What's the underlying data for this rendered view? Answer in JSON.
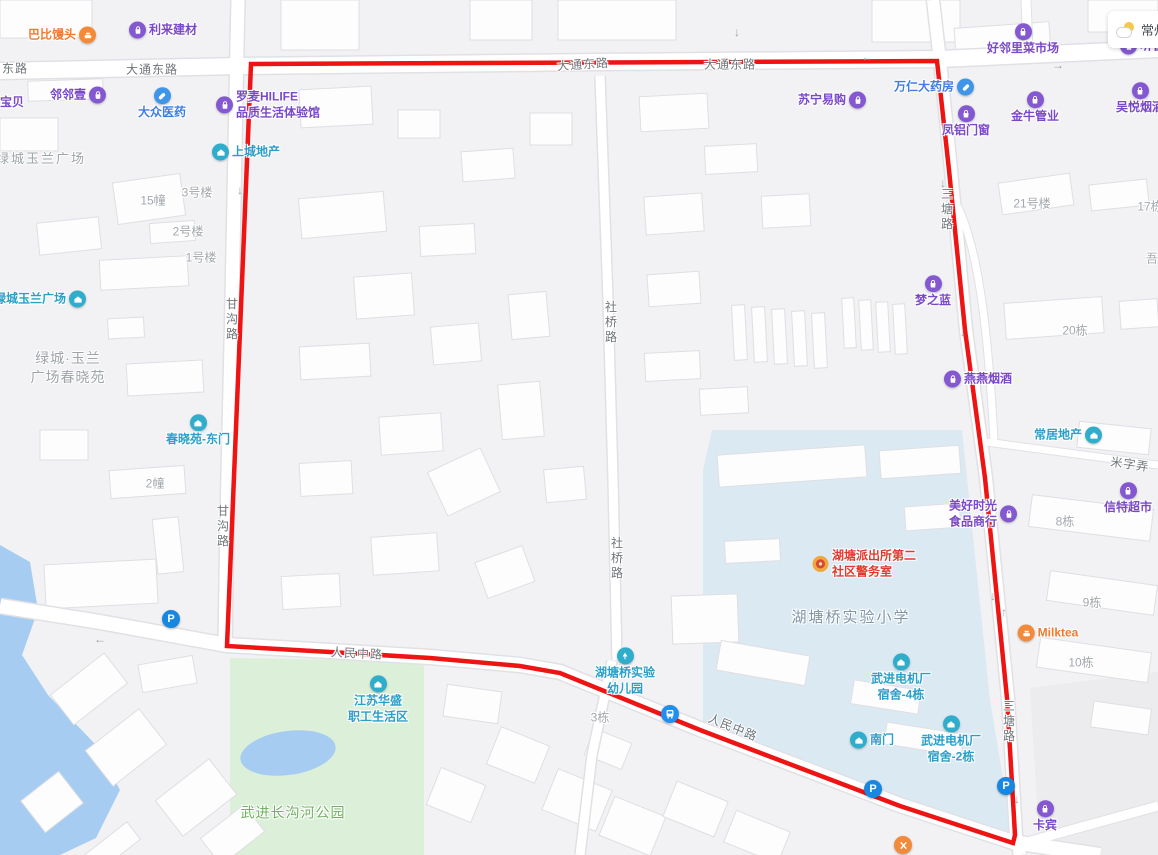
{
  "app": {
    "type": "web-map",
    "weather_city": "常州"
  },
  "colors": {
    "purple": "#7a49c8",
    "teal": "#2a9fc7",
    "blue": "#3f7de0",
    "orange": "#f2792e",
    "red": "#e03a30",
    "icon_purple": "#8458d0",
    "icon_teal": "#31adcc",
    "icon_blue": "#3f96e8",
    "icon_orange": "#f28a3c",
    "parking_blue": "#1787e0",
    "bus_blue": "#2090f0",
    "boundary_red": "#ee1414",
    "park_green_label": "#6fb161",
    "area_gray": "#9da3a8",
    "road_gray": "#6f757a",
    "school_label": "#7f95a8",
    "police_gold": "#f0a73c",
    "police_core": "#d8483a"
  },
  "boundary": {
    "color": "#ee1414",
    "points": "251,64 937,61 949,170 965,330 985,478 1007,698 1015,835 1013,843 900,806 800,768 700,730 560,673 520,666 430,658 330,652 227,646"
  },
  "roads": {
    "labels": [
      {
        "text": "东路",
        "x": 15,
        "y": 68
      },
      {
        "text": "大通东路",
        "x": 152,
        "y": 69
      },
      {
        "text": "大通东路",
        "x": 583,
        "y": 64,
        "rotate": -4
      },
      {
        "text": "大通东路",
        "x": 730,
        "y": 64
      },
      {
        "text": "甘沟路",
        "x": 232,
        "y": 320,
        "vertical": true
      },
      {
        "text": "甘沟路",
        "x": 223,
        "y": 527,
        "vertical": true
      },
      {
        "text": "社桥路",
        "x": 611,
        "y": 323,
        "vertical": true
      },
      {
        "text": "社桥路",
        "x": 617,
        "y": 559,
        "vertical": true
      },
      {
        "text": "三塘路",
        "x": 947,
        "y": 210,
        "vertical": true
      },
      {
        "text": "三塘路",
        "x": 1009,
        "y": 722,
        "vertical": true
      },
      {
        "text": "人民中路",
        "x": 357,
        "y": 653,
        "rotate": 3
      },
      {
        "text": "人民中路",
        "x": 733,
        "y": 727,
        "rotate": 22
      },
      {
        "text": "米字弄",
        "x": 1130,
        "y": 464,
        "rotate": 8
      }
    ]
  },
  "areas": {
    "labels": [
      {
        "name": "lvcheng-yulan-plaza-area",
        "lines": [
          "绿城玉兰广场"
        ],
        "x": 41,
        "y": 159,
        "color": "area_gray",
        "size": 13,
        "ls": 2
      },
      {
        "name": "chunxiao-garden-area",
        "lines": [
          "绿城·玉兰",
          "广场春晓苑"
        ],
        "x": 68,
        "y": 368,
        "color": "area_gray",
        "size": 14,
        "ls": 1
      },
      {
        "name": "changgouhe-park-area",
        "lines": [
          "武进长沟河公园"
        ],
        "x": 293,
        "y": 813,
        "color": "park_green_label",
        "size": 14,
        "ls": 1
      },
      {
        "name": "hutangqiao-school-area",
        "lines": [
          "湖塘桥实验小学"
        ],
        "x": 851,
        "y": 618,
        "color": "school_label",
        "size": 15,
        "ls": 2
      }
    ]
  },
  "buildings": {
    "labels": [
      {
        "text": "15幢",
        "x": 153,
        "y": 200
      },
      {
        "text": "3号楼",
        "x": 197,
        "y": 192
      },
      {
        "text": "2号楼",
        "x": 188,
        "y": 231
      },
      {
        "text": "1号楼",
        "x": 201,
        "y": 257
      },
      {
        "text": "2幢",
        "x": 155,
        "y": 483
      },
      {
        "text": "3栋",
        "x": 600,
        "y": 717
      },
      {
        "text": "21号楼",
        "x": 1032,
        "y": 203
      },
      {
        "text": "17栋",
        "x": 1150,
        "y": 206
      },
      {
        "text": "吾",
        "x": 1152,
        "y": 258
      },
      {
        "text": "20栋",
        "x": 1075,
        "y": 330
      },
      {
        "text": "8栋",
        "x": 1065,
        "y": 521
      },
      {
        "text": "9栋",
        "x": 1092,
        "y": 602
      },
      {
        "text": "10栋",
        "x": 1081,
        "y": 662
      }
    ]
  },
  "pois": [
    {
      "name": "babi-mantou",
      "lines": [
        "巴比馒头"
      ],
      "x": 62,
      "y": 35,
      "color": "orange",
      "icon": "food",
      "pos": "right"
    },
    {
      "name": "lilai-jiancai",
      "lines": [
        "利来建材"
      ],
      "x": 163,
      "y": 30,
      "color": "purple",
      "icon": "bag",
      "pos": "left"
    },
    {
      "name": "linlinyi",
      "lines": [
        "邻邻壹"
      ],
      "x": 78,
      "y": 95,
      "color": "purple",
      "icon": "bag",
      "pos": "right"
    },
    {
      "name": "baobei",
      "lines": [
        "宝贝"
      ],
      "x": 12,
      "y": 103,
      "color": "purple",
      "icon": "none",
      "pos": "left"
    },
    {
      "name": "dazhong-yiyao",
      "lines": [
        "大众医药"
      ],
      "x": 162,
      "y": 104,
      "color": "blue",
      "icon": "pill",
      "pos": "top"
    },
    {
      "name": "luomai-hilife",
      "lines": [
        "罗麦HILIFE",
        "品质生活体验馆"
      ],
      "x": 268,
      "y": 105,
      "color": "purple",
      "icon": "bag",
      "pos": "left"
    },
    {
      "name": "shangcheng-dichan",
      "lines": [
        "上城地产"
      ],
      "x": 246,
      "y": 152,
      "color": "teal",
      "icon": "house",
      "pos": "left"
    },
    {
      "name": "suning-yigou",
      "lines": [
        "苏宁易购"
      ],
      "x": 832,
      "y": 100,
      "color": "purple",
      "icon": "bag",
      "pos": "right"
    },
    {
      "name": "wanren-dayaofang",
      "lines": [
        "万仁大药房"
      ],
      "x": 934,
      "y": 87,
      "color": "blue",
      "icon": "pill",
      "pos": "right"
    },
    {
      "name": "fenglv-menchuang",
      "lines": [
        "凤铝门窗"
      ],
      "x": 966,
      "y": 122,
      "color": "purple",
      "icon": "bag",
      "pos": "top"
    },
    {
      "name": "jinniu-guanye",
      "lines": [
        "金牛管业"
      ],
      "x": 1035,
      "y": 108,
      "color": "purple",
      "icon": "bag",
      "pos": "top"
    },
    {
      "name": "wuyue-yanjiu",
      "lines": [
        "吴悦烟酒"
      ],
      "x": 1140,
      "y": 99,
      "color": "purple",
      "icon": "bag",
      "pos": "top"
    },
    {
      "name": "haolinli-market",
      "lines": [
        "好邻里菜市场"
      ],
      "x": 1023,
      "y": 40,
      "color": "purple",
      "icon": "bag",
      "pos": "top"
    },
    {
      "name": "tingchun",
      "lines": [
        "听春"
      ],
      "x": 1142,
      "y": 46,
      "color": "purple",
      "icon": "bag",
      "pos": "left"
    },
    {
      "name": "mengzhilan",
      "lines": [
        "梦之蓝"
      ],
      "x": 933,
      "y": 292,
      "color": "purple",
      "icon": "bag",
      "pos": "top"
    },
    {
      "name": "yanyan-yanjiu",
      "lines": [
        "燕燕烟酒"
      ],
      "x": 978,
      "y": 379,
      "color": "purple",
      "icon": "bag",
      "pos": "left"
    },
    {
      "name": "changju-dichan",
      "lines": [
        "常居地产"
      ],
      "x": 1068,
      "y": 435,
      "color": "teal",
      "icon": "house",
      "pos": "right"
    },
    {
      "name": "meihao-shiguang",
      "lines": [
        "美好时光",
        "食品商行"
      ],
      "x": 983,
      "y": 514,
      "color": "purple",
      "icon": "bag",
      "pos": "right"
    },
    {
      "name": "xinte-chaoshi",
      "lines": [
        "信特超市"
      ],
      "x": 1128,
      "y": 499,
      "color": "purple",
      "icon": "bag",
      "pos": "top"
    },
    {
      "name": "milktea",
      "lines": [
        "Milktea"
      ],
      "x": 1048,
      "y": 633,
      "color": "orange",
      "icon": "food",
      "pos": "left"
    },
    {
      "name": "kabin",
      "lines": [
        "卡宾"
      ],
      "x": 1045,
      "y": 817,
      "color": "purple",
      "icon": "bag",
      "pos": "top"
    },
    {
      "name": "hutang-police-station",
      "lines": [
        "湖塘派出所第二",
        "社区警务室"
      ],
      "x": 864,
      "y": 564,
      "color": "red",
      "icon": "police",
      "pos": "left"
    },
    {
      "name": "dianjichang-sushe-4",
      "lines": [
        "武进电机厂",
        "宿舍-4栋"
      ],
      "x": 901,
      "y": 678,
      "color": "teal",
      "icon": "house",
      "pos": "top"
    },
    {
      "name": "dianjichang-sushe-2",
      "lines": [
        "武进电机厂",
        "宿舍-2栋"
      ],
      "x": 951,
      "y": 740,
      "color": "teal",
      "icon": "house",
      "pos": "top"
    },
    {
      "name": "nanmen-gate",
      "lines": [
        "南门"
      ],
      "x": 872,
      "y": 740,
      "color": "teal",
      "icon": "house",
      "pos": "left"
    },
    {
      "name": "jiangsu-huasheng",
      "lines": [
        "江苏华盛",
        "职工生活区"
      ],
      "x": 378,
      "y": 700,
      "color": "teal",
      "icon": "house",
      "pos": "top"
    },
    {
      "name": "hutangqiao-kindergarten",
      "lines": [
        "湖塘桥实验",
        "幼儿园"
      ],
      "x": 625,
      "y": 672,
      "color": "teal",
      "icon": "tree",
      "pos": "top"
    },
    {
      "name": "chunxiaoyuan-east-gate",
      "lines": [
        "春晓苑-东门"
      ],
      "x": 198,
      "y": 431,
      "color": "teal",
      "icon": "house",
      "pos": "top"
    },
    {
      "name": "lvcheng-yulan-plaza-poi",
      "lines": [
        "绿城玉兰广场"
      ],
      "x": 40,
      "y": 299,
      "color": "teal",
      "icon": "house",
      "pos": "right"
    }
  ],
  "markers": [
    {
      "name": "parking-lvcheng",
      "type": "parking",
      "label": "P",
      "x": 171,
      "y": 619
    },
    {
      "name": "parking-renmin",
      "type": "parking",
      "label": "P",
      "x": 873,
      "y": 789
    },
    {
      "name": "parking-santang",
      "type": "parking",
      "label": "P",
      "x": 1006,
      "y": 786
    },
    {
      "name": "bus-stop-renmin",
      "type": "bus",
      "x": 670,
      "y": 714
    },
    {
      "name": "restaurant-marker",
      "type": "restaurant",
      "x": 903,
      "y": 845
    }
  ],
  "arrows": [
    {
      "x": 737,
      "y": 32,
      "glyph": "↓"
    },
    {
      "x": 867,
      "y": 57,
      "glyph": "←"
    },
    {
      "x": 1058,
      "y": 65,
      "glyph": "→"
    },
    {
      "x": 239,
      "y": 95,
      "glyph": "↓"
    },
    {
      "x": 240,
      "y": 190,
      "glyph": "↓"
    },
    {
      "x": 943,
      "y": 183,
      "glyph": "↓"
    },
    {
      "x": 963,
      "y": 332,
      "glyph": "↓"
    },
    {
      "x": 993,
      "y": 596,
      "glyph": "↓"
    },
    {
      "x": 1004,
      "y": 612,
      "glyph": "↑"
    },
    {
      "x": 1017,
      "y": 799,
      "glyph": "↓"
    },
    {
      "x": 100,
      "y": 639,
      "glyph": "←"
    }
  ]
}
